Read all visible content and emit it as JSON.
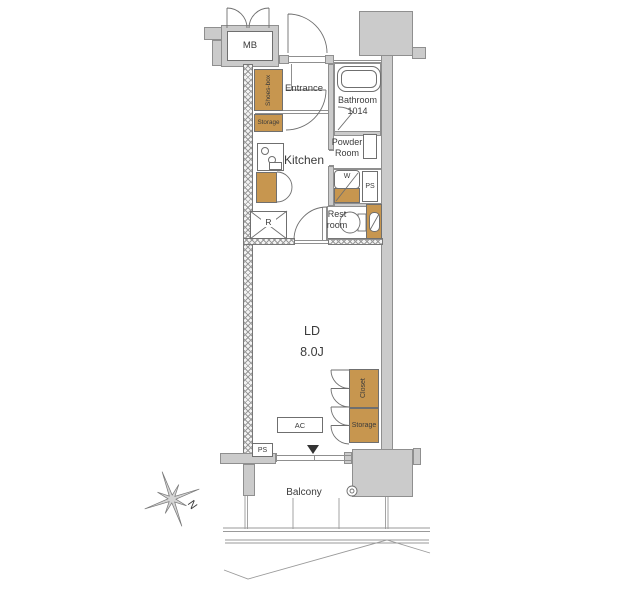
{
  "labels": {
    "mb": "MB",
    "entrance": "Entrance",
    "shoes_box": "Shoes-box",
    "storage_upper": "Storage",
    "kitchen": "Kitchen",
    "bathroom": "Bathroom",
    "bathroom_size": "1014",
    "powder_1": "Powder",
    "powder_2": "Room",
    "washer": "W",
    "ps_middle": "PS",
    "rest_1": "Rest",
    "rest_2": "room",
    "refrigerator": "R",
    "living": "LD",
    "living_size": "8.0J",
    "closet": "Closet",
    "storage_lower": "Storage",
    "ac": "AC",
    "ps_lower": "PS",
    "balcony": "Balcony",
    "compass_north": "N"
  },
  "colors": {
    "cabinet_wood": "#c7964f",
    "wall_gray": "#cbcbcb",
    "outline": "#6f6f6f"
  }
}
